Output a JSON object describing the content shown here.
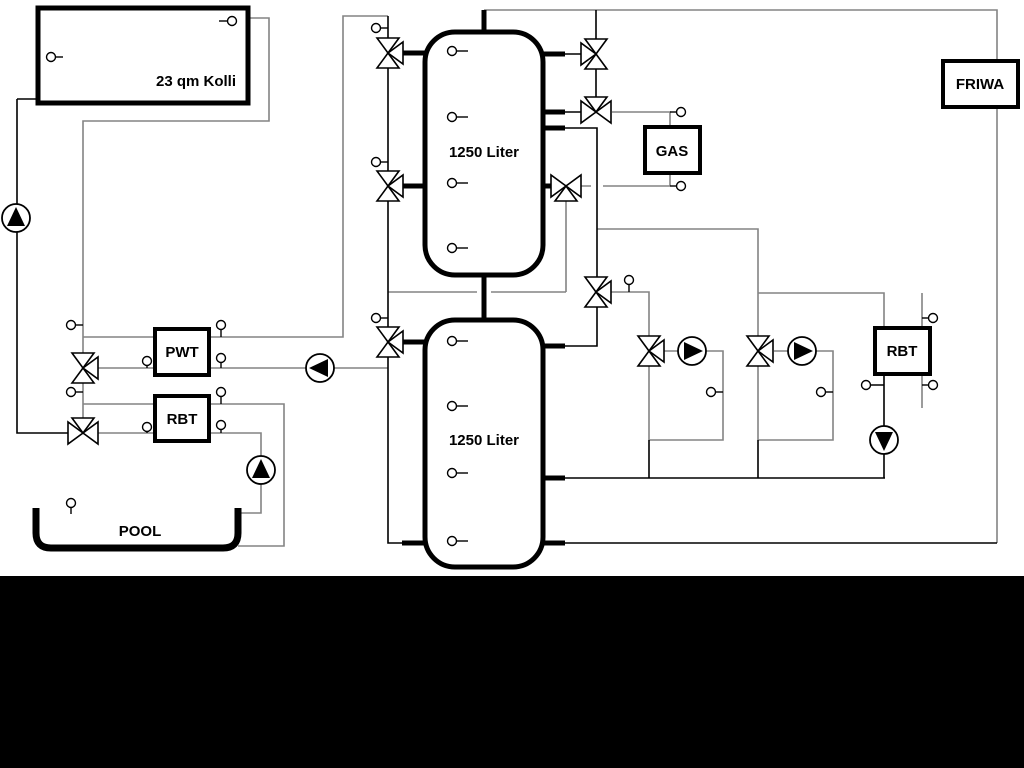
{
  "diagram": {
    "title": "heating-schematic",
    "labels": {
      "collector": "23 qm Kolli",
      "tank_top": "1250 Liter",
      "tank_bottom": "1250 Liter",
      "gas": "GAS",
      "friwa": "FRIWA",
      "pwt": "PWT",
      "rbt_left": "RBT",
      "rbt_right": "RBT",
      "pool": "POOL"
    },
    "colors": {
      "line_gray": "#848484",
      "line_black": "#000000",
      "background": "#ffffff",
      "bottom_band": "#000000"
    }
  }
}
